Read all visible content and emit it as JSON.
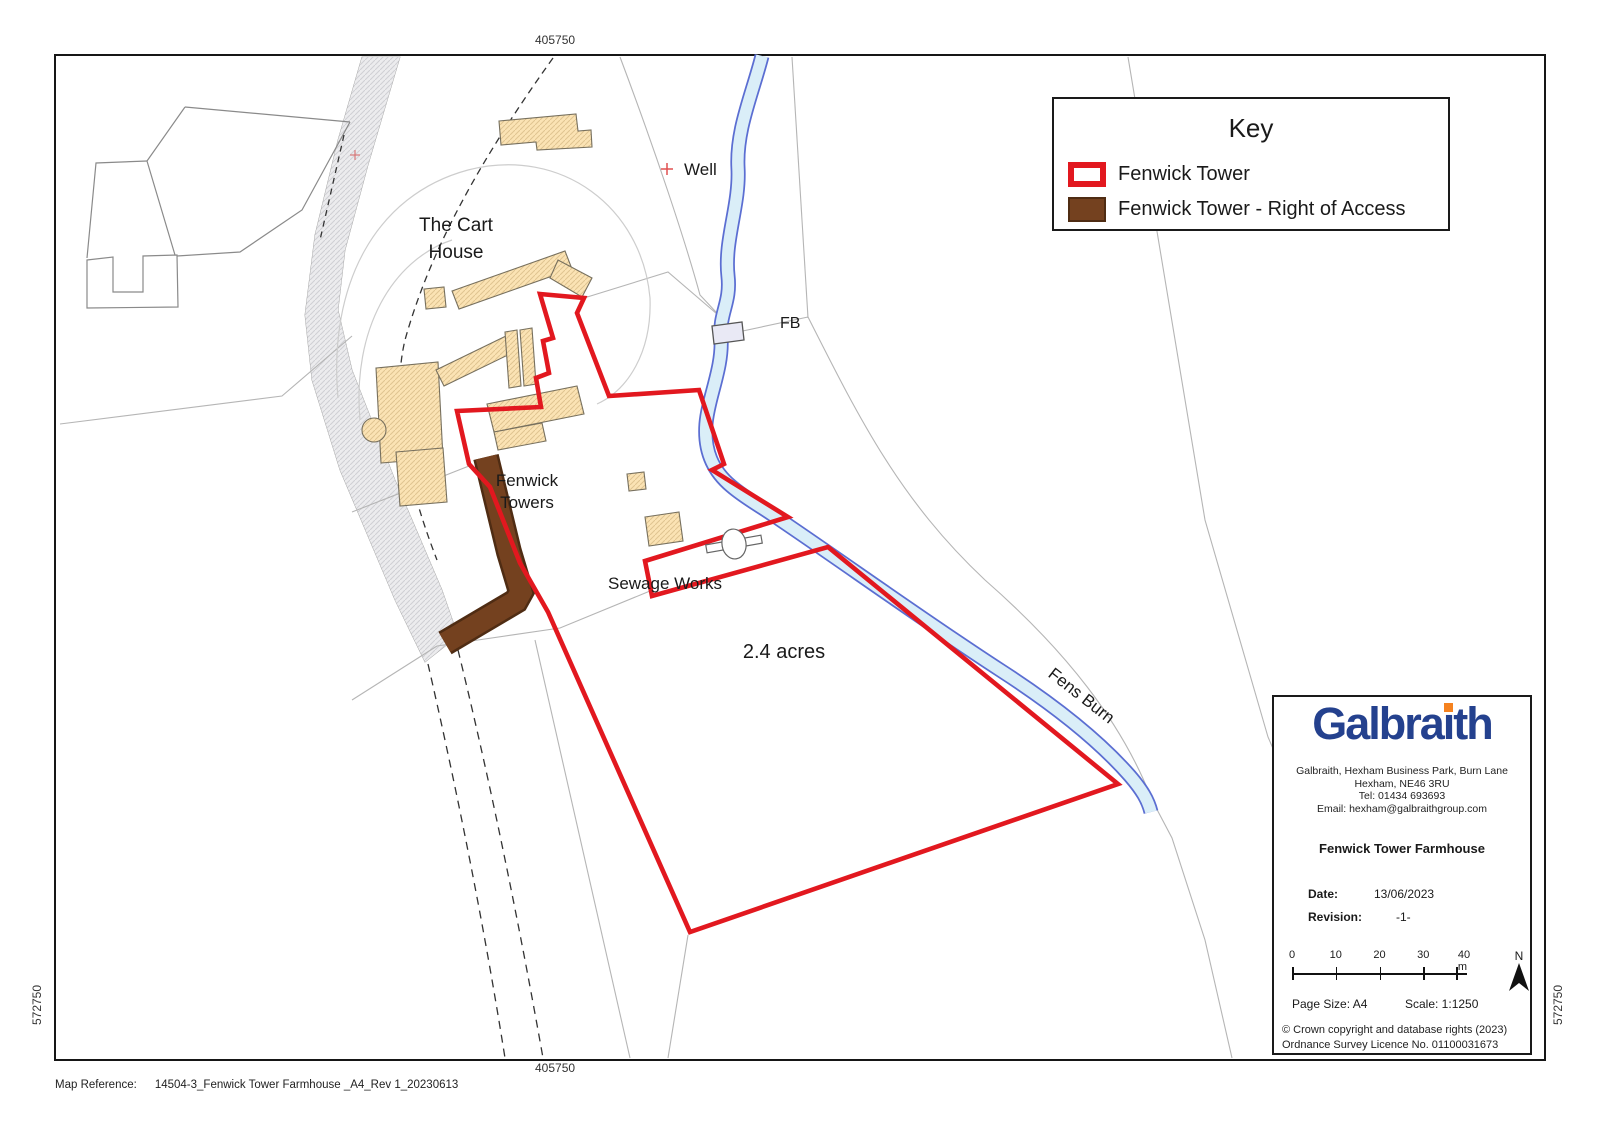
{
  "frame": {
    "top_coord": "405750",
    "bottom_coord": "405750",
    "left_coord": "572750",
    "right_coord": "572750"
  },
  "key": {
    "title": "Key",
    "items": [
      {
        "label": "Fenwick Tower",
        "swatch": "red-outline"
      },
      {
        "label": "Fenwick Tower - Right of Access",
        "swatch": "brown-fill"
      }
    ]
  },
  "map_labels": {
    "cart_house_line1": "The Cart",
    "cart_house_line2": "House",
    "well": "Well",
    "fb": "FB",
    "fenwick_towers_line1": "Fenwick",
    "fenwick_towers_line2": "Towers",
    "sewage_works": "Sewage Works",
    "acreage": "2.4 acres",
    "fens_burn": "Fens Burn"
  },
  "info_panel": {
    "logo": {
      "pre": "Galbra",
      "i_stem": "ı",
      "post": "th"
    },
    "address_line1": "Galbraith, Hexham Business Park, Burn Lane",
    "address_line2": "Hexham, NE46 3RU",
    "address_line3": "Tel: 01434 693693",
    "address_line4": "Email: hexham@galbraithgroup.com",
    "title": "Fenwick Tower Farmhouse",
    "date_label": "Date:",
    "date_value": "13/06/2023",
    "revision_label": "Revision:",
    "revision_value": "-1-",
    "scalebar_ticks": [
      "0",
      "10",
      "20",
      "30",
      "40 m"
    ],
    "north_label": "N",
    "page_size": "Page Size: A4",
    "scale": "Scale: 1:1250",
    "copyright_line1": "© Crown copyright and database rights (2023)",
    "copyright_line2": "Ordnance Survey Licence No. 01100031673"
  },
  "map_reference": {
    "label": "Map Reference:",
    "value": "14504-3_Fenwick Tower Farmhouse _A4_Rev 1_20230613"
  },
  "colors": {
    "boundary_red": "#e2181f",
    "access_brown": "#74411f",
    "access_brown_dark": "#4f2c13",
    "building_fill": "#fbe3b4",
    "building_outline": "#77705e",
    "stream_fill": "#daeef8",
    "stream_edge": "#5b6ed2",
    "road_fill": "#ebebee",
    "parcel_line": "#b5b5b5",
    "logo_navy": "#24418e",
    "logo_orange": "#f5821f"
  }
}
